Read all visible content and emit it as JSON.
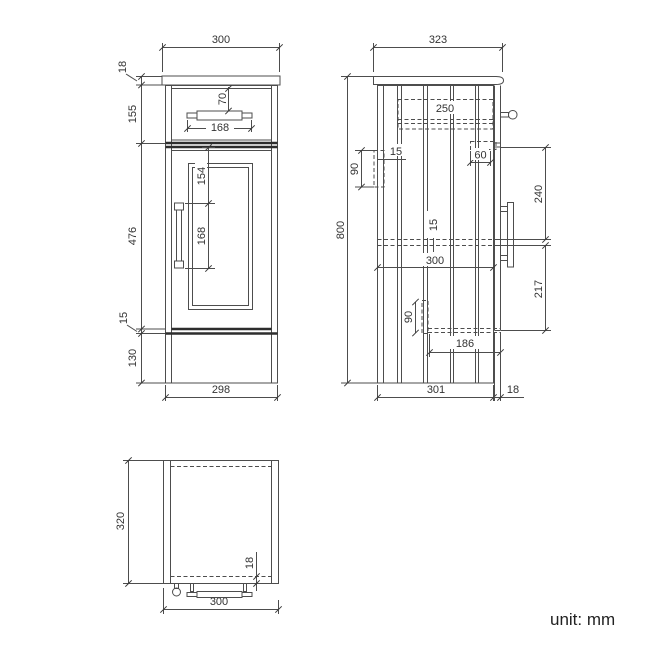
{
  "unit_note": "unit: mm",
  "colors": {
    "line": "#4d4d4d",
    "dark_line": "#2d2d2d",
    "text": "#333333",
    "background": "#ffffff"
  },
  "front_view": {
    "countertop_width": "300",
    "countertop_thickness": "18",
    "drawer_section_height": "155",
    "drawer_handle_offset": "70",
    "drawer_handle_width": "168",
    "door_section_height": "476",
    "door_handle_top_offset": "154",
    "door_handle_length": "168",
    "door_bottom_gap": "15",
    "plinth_height": "130",
    "carcass_width": "298"
  },
  "side_view": {
    "countertop_depth": "323",
    "overall_height": "800",
    "drawer_box_depth": "250",
    "wall_bracket_height": "90",
    "wall_bracket_thickness": "15",
    "hinge_inset": "60",
    "door_top_to_shelf": "240",
    "shelf_thickness": "15",
    "shelf_depth": "300",
    "shelf_to_door_bottom": "217",
    "bottom_bracket_height": "90",
    "bottom_bracket_to_front": "186",
    "carcass_depth": "301",
    "door_thickness": "18"
  },
  "top_view": {
    "depth": "320",
    "front_panel_thickness": "18",
    "width": "300"
  }
}
